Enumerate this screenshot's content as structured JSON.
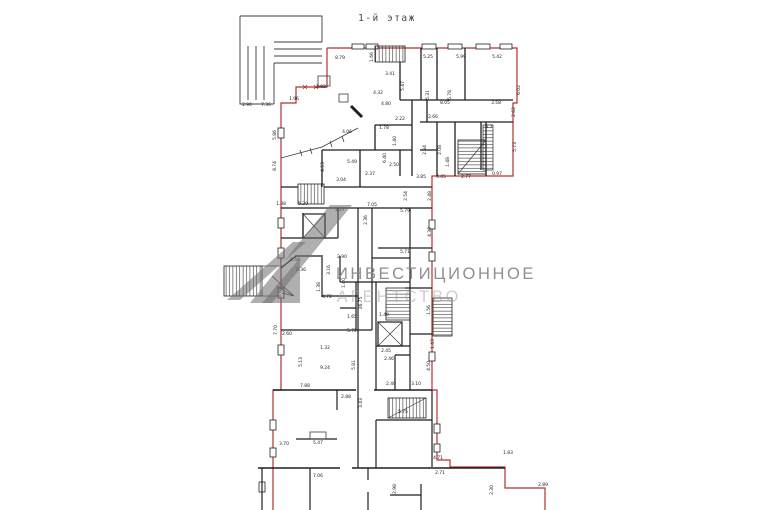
{
  "title": "1-й этаж",
  "watermark": {
    "line1": "ИНВЕСТИЦИОННОЕ",
    "line2": "АГЕНТСТВО"
  },
  "colors": {
    "outline_red": "#b23230",
    "wall": "#1f1f1f",
    "watermark_gray": "#6e6e6e",
    "dim_text": "#1a1a1a"
  },
  "dimension_labels": [
    {
      "x": 340,
      "y": 59,
      "t": "8.79"
    },
    {
      "x": 373,
      "y": 57,
      "t": "1.66",
      "r": 1
    },
    {
      "x": 390,
      "y": 75,
      "t": "3.41"
    },
    {
      "x": 428,
      "y": 58,
      "t": "5.25"
    },
    {
      "x": 461,
      "y": 58,
      "t": "5.99"
    },
    {
      "x": 497,
      "y": 58,
      "t": "5.42"
    },
    {
      "x": 404,
      "y": 86,
      "t": "5.47",
      "r": 1
    },
    {
      "x": 429,
      "y": 95,
      "t": "5.31",
      "r": 1
    },
    {
      "x": 451,
      "y": 95,
      "t": "5.78",
      "r": 1
    },
    {
      "x": 445,
      "y": 104,
      "t": "8.05"
    },
    {
      "x": 496,
      "y": 104,
      "t": "3.58"
    },
    {
      "x": 520,
      "y": 90,
      "t": "6.02",
      "r": 1
    },
    {
      "x": 515,
      "y": 112,
      "t": "2.62",
      "r": 1
    },
    {
      "x": 247,
      "y": 106,
      "t": "2.90"
    },
    {
      "x": 266,
      "y": 106,
      "t": "7.36"
    },
    {
      "x": 294,
      "y": 100,
      "t": "1.96"
    },
    {
      "x": 321,
      "y": 88,
      "t": "2.02"
    },
    {
      "x": 276,
      "y": 135,
      "t": "5.86",
      "r": 1
    },
    {
      "x": 276,
      "y": 166,
      "t": "8.74",
      "r": 1
    },
    {
      "x": 378,
      "y": 94,
      "t": "4.32"
    },
    {
      "x": 386,
      "y": 105,
      "t": "4.80"
    },
    {
      "x": 400,
      "y": 120,
      "t": "2.22"
    },
    {
      "x": 347,
      "y": 133,
      "t": "4.06"
    },
    {
      "x": 386,
      "y": 158,
      "t": "6.40",
      "r": 1
    },
    {
      "x": 394,
      "y": 166,
      "t": "2.50"
    },
    {
      "x": 384,
      "y": 129,
      "t": "1.78"
    },
    {
      "x": 396,
      "y": 141,
      "t": "1.40",
      "r": 1
    },
    {
      "x": 324,
      "y": 167,
      "t": "4.53",
      "r": 1
    },
    {
      "x": 341,
      "y": 181,
      "t": "3.04"
    },
    {
      "x": 370,
      "y": 175,
      "t": "2.37"
    },
    {
      "x": 352,
      "y": 163,
      "t": "5.49"
    },
    {
      "x": 433,
      "y": 118,
      "t": "2.66"
    },
    {
      "x": 426,
      "y": 150,
      "t": "2.84",
      "r": 1
    },
    {
      "x": 441,
      "y": 150,
      "t": "2.08",
      "r": 1
    },
    {
      "x": 449,
      "y": 162,
      "t": "1.48",
      "r": 1
    },
    {
      "x": 421,
      "y": 178,
      "t": "3.85"
    },
    {
      "x": 441,
      "y": 178,
      "t": "4.05"
    },
    {
      "x": 466,
      "y": 178,
      "t": "2.77"
    },
    {
      "x": 497,
      "y": 175,
      "t": "0.97"
    },
    {
      "x": 516,
      "y": 147,
      "t": "5.73",
      "r": 1
    },
    {
      "x": 489,
      "y": 128,
      "t": "5.7"
    },
    {
      "x": 281,
      "y": 205,
      "t": "1.38"
    },
    {
      "x": 303,
      "y": 205,
      "t": "5.20"
    },
    {
      "x": 340,
      "y": 211,
      "t": "2.27"
    },
    {
      "x": 372,
      "y": 206,
      "t": "7.05"
    },
    {
      "x": 367,
      "y": 220,
      "t": "2.36",
      "r": 1
    },
    {
      "x": 405,
      "y": 212,
      "t": "5.79"
    },
    {
      "x": 407,
      "y": 196,
      "t": "2.54",
      "r": 1
    },
    {
      "x": 431,
      "y": 196,
      "t": "2.48",
      "r": 1
    },
    {
      "x": 431,
      "y": 232,
      "t": "4.30",
      "r": 1
    },
    {
      "x": 405,
      "y": 253,
      "t": "5.71"
    },
    {
      "x": 295,
      "y": 261,
      "t": "5.44"
    },
    {
      "x": 301,
      "y": 271,
      "t": "6.36"
    },
    {
      "x": 330,
      "y": 270,
      "t": "3.16",
      "r": 1
    },
    {
      "x": 342,
      "y": 258,
      "t": "2.90"
    },
    {
      "x": 320,
      "y": 287,
      "t": "1.38",
      "r": 1
    },
    {
      "x": 327,
      "y": 298,
      "t": "4.72"
    },
    {
      "x": 362,
      "y": 303,
      "t": "26.75",
      "r": 1
    },
    {
      "x": 345,
      "y": 283,
      "t": "1.40",
      "r": 1
    },
    {
      "x": 352,
      "y": 318,
      "t": "1.65"
    },
    {
      "x": 352,
      "y": 332,
      "t": "5.72"
    },
    {
      "x": 384,
      "y": 316,
      "t": "1.49"
    },
    {
      "x": 430,
      "y": 310,
      "t": "1.56",
      "r": 1
    },
    {
      "x": 430,
      "y": 366,
      "t": "4.50",
      "r": 1
    },
    {
      "x": 389,
      "y": 360,
      "t": "2.46"
    },
    {
      "x": 391,
      "y": 385,
      "t": "2.40"
    },
    {
      "x": 416,
      "y": 385,
      "t": "3.10"
    },
    {
      "x": 386,
      "y": 352,
      "t": "2.45"
    },
    {
      "x": 434,
      "y": 344,
      "t": "1.43",
      "r": 1
    },
    {
      "x": 302,
      "y": 362,
      "t": "5.13",
      "r": 1
    },
    {
      "x": 325,
      "y": 369,
      "t": "9.24"
    },
    {
      "x": 325,
      "y": 349,
      "t": "1.32"
    },
    {
      "x": 287,
      "y": 335,
      "t": "2.60"
    },
    {
      "x": 305,
      "y": 387,
      "t": "7.88"
    },
    {
      "x": 355,
      "y": 365,
      "t": "5.81",
      "r": 1
    },
    {
      "x": 346,
      "y": 398,
      "t": "2.88"
    },
    {
      "x": 277,
      "y": 330,
      "t": "7.70",
      "r": 1
    },
    {
      "x": 318,
      "y": 444,
      "t": "5.47"
    },
    {
      "x": 284,
      "y": 445,
      "t": "3.70"
    },
    {
      "x": 318,
      "y": 477,
      "t": "7.06"
    },
    {
      "x": 438,
      "y": 459,
      "t": "4.71"
    },
    {
      "x": 440,
      "y": 474,
      "t": "2.71"
    },
    {
      "x": 508,
      "y": 454,
      "t": "1.83"
    },
    {
      "x": 396,
      "y": 489,
      "t": "2.98",
      "r": 1
    },
    {
      "x": 543,
      "y": 486,
      "t": "2.89"
    },
    {
      "x": 493,
      "y": 490,
      "t": "2.30",
      "r": 1
    },
    {
      "x": 362,
      "y": 403,
      "t": "3.43",
      "r": 1
    },
    {
      "x": 403,
      "y": 413,
      "t": "5.75"
    }
  ]
}
